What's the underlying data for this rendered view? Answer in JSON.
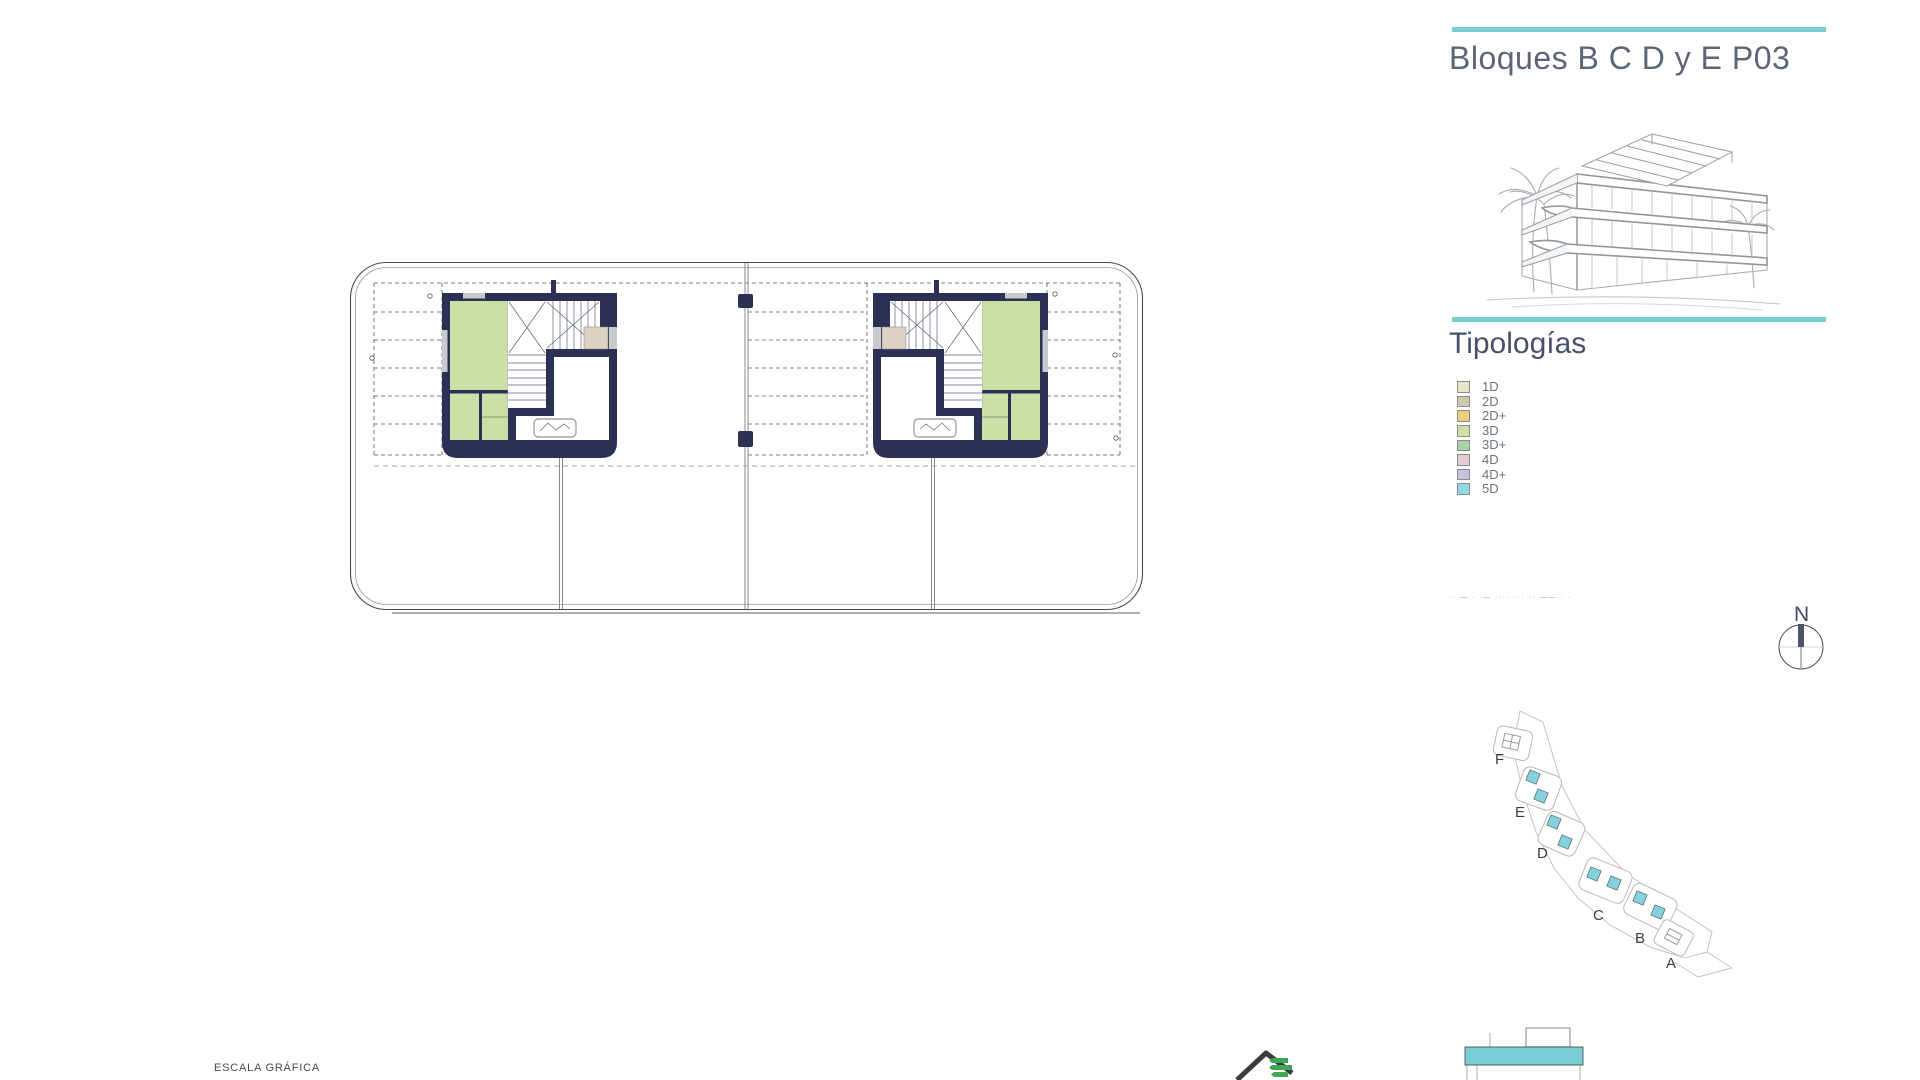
{
  "title": "Bloques B C D y E P03",
  "sections": {
    "tipologias": "Tipologías"
  },
  "legend": {
    "items": [
      {
        "label": "1D",
        "color": "#e9e5c9"
      },
      {
        "label": "2D",
        "color": "#cfc7ae"
      },
      {
        "label": "2D+",
        "color": "#f3ca82"
      },
      {
        "label": "3D",
        "color": "#cfe1a5"
      },
      {
        "label": "3D+",
        "color": "#a5d3a6"
      },
      {
        "label": "4D",
        "color": "#e6cad4"
      },
      {
        "label": "4D+",
        "color": "#c6c1dc"
      },
      {
        "label": "5D",
        "color": "#8fdbe1"
      }
    ]
  },
  "note": {
    "text": "·· — · ·— ···· ··· ·· ——·· ·"
  },
  "compass": {
    "label": "N"
  },
  "site_plan": {
    "labels": [
      {
        "t": "F",
        "x": 35,
        "y": 64
      },
      {
        "t": "E",
        "x": 55,
        "y": 117
      },
      {
        "t": "D",
        "x": 77,
        "y": 158
      },
      {
        "t": "C",
        "x": 133,
        "y": 220
      },
      {
        "t": "B",
        "x": 175,
        "y": 243
      },
      {
        "t": "A",
        "x": 206,
        "y": 268
      }
    ],
    "highlighted_blocks": [
      {
        "x": 73,
        "y": 77
      },
      {
        "x": 81,
        "y": 96
      },
      {
        "x": 94,
        "y": 122
      },
      {
        "x": 105,
        "y": 142
      },
      {
        "x": 134,
        "y": 174
      },
      {
        "x": 154,
        "y": 183
      },
      {
        "x": 180,
        "y": 198
      },
      {
        "x": 198,
        "y": 212
      }
    ]
  },
  "scale_bar": {
    "label": "ESCALA GRÁFICA"
  },
  "colors": {
    "accent": "#79ced6",
    "navy": "#2b3054",
    "green": "#cbdfa7",
    "beige": "#ddd3c4",
    "glass": "#c9cace",
    "cyan": "#86d2da",
    "logo_green": "#3fa557"
  }
}
